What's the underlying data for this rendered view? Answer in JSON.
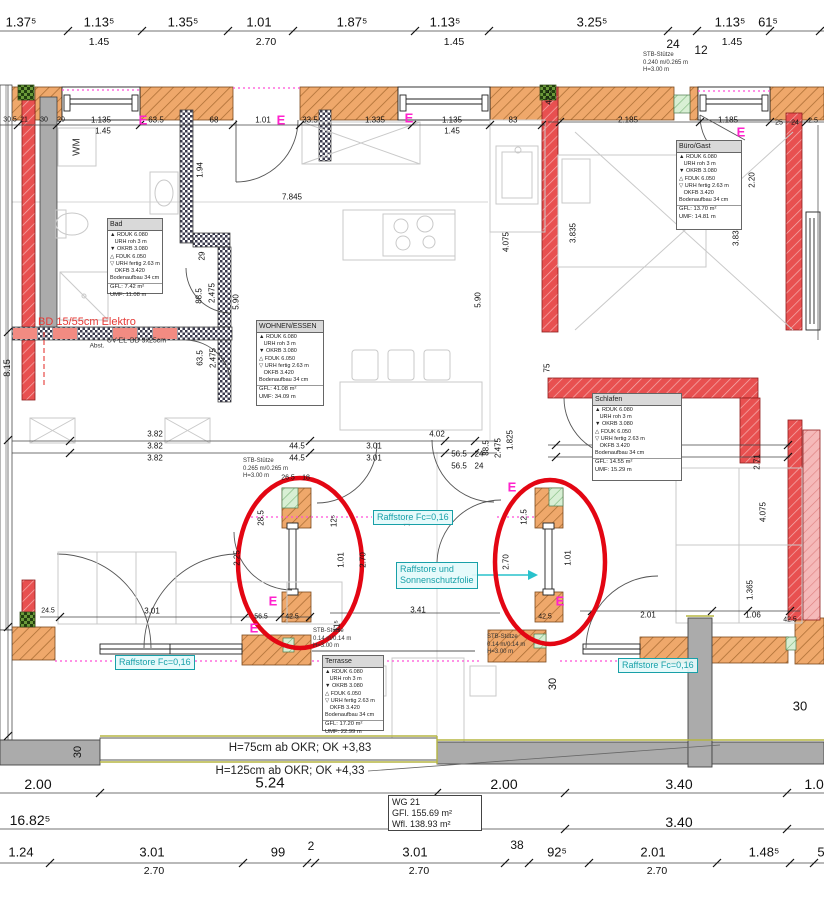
{
  "site": {
    "h75": "H=75cm ab OKR; OK +3,83",
    "h125": "H=125cm ab OKR; OK +4,33"
  },
  "wg_box": {
    "line1": "WG 21",
    "line2": "GFl.   155.69 m²",
    "line3": "Wfl.   138.93 m²"
  },
  "colors": {
    "wall_orange": "#efa86b",
    "wall_red": "#e85050",
    "wall_pink": "#f5b9b9",
    "insulation_green": "#d8efd4",
    "checker_dark": "#3a3a4d",
    "gray_wall": "#ababab",
    "accent_cyan": "#18a0a8",
    "magenta": "#ff22cc",
    "highlight_red": "#e30613",
    "elektro_red": "#e53935",
    "olive": "#b5b542"
  },
  "room_template_lines": "▲ RDUK 6.080\n   URH roh 3 m\n▼ OKRB 3.080\n△ FDUK 6.050\n▽ URH fertig 2.63 m\n   OKFB 3.420\nBodenaufbau 34 cm",
  "rooms": [
    {
      "name": "Bad",
      "x": 107,
      "y": 218,
      "w": 54,
      "h": 74,
      "gfl": "GFL: 7.42 m²",
      "umf": "UMF: 11.08 m"
    },
    {
      "name": "WOHNEN/ESSEN",
      "x": 256,
      "y": 320,
      "w": 66,
      "h": 84,
      "gfl": "GFL: 41.08 m²",
      "umf": "UMF: 34.09 m"
    },
    {
      "name": "Büro/Gast",
      "x": 676,
      "y": 140,
      "w": 64,
      "h": 88,
      "gfl": "GFL: 13.70 m²",
      "umf": "UMF: 14.81 m"
    },
    {
      "name": "Schlafen",
      "x": 592,
      "y": 393,
      "w": 88,
      "h": 86,
      "gfl": "GFL: 14.55 m²",
      "umf": "UMF: 15.29 m"
    },
    {
      "name": "Terrasse",
      "x": 322,
      "y": 655,
      "w": 60,
      "h": 74,
      "gfl": "GFL: 17.20 m²",
      "umf": "UMF: 22.99 m"
    }
  ],
  "stb_labels": [
    {
      "x": 643,
      "y": 52,
      "text": "STB-Stütze\n0.240 m/0.265 m\nH=3.00 m"
    },
    {
      "x": 243,
      "y": 458,
      "text": "STB-Stütze\n0.265 m/0.265 m\nH=3.00 m"
    },
    {
      "x": 313,
      "y": 628,
      "text": "STB-Stütze\n0.14 m/0.14 m\nH=3.00 m"
    },
    {
      "x": 487,
      "y": 634,
      "text": "STB-Stütze\n0.14 m/0.14 m\nH=3.00 m"
    }
  ],
  "raffstore_labels": [
    {
      "x": 115,
      "y": 655,
      "lines": [
        "Raffstore Fc=0,16"
      ]
    },
    {
      "x": 373,
      "y": 510,
      "lines": [
        "Raffstore Fc=0,16"
      ]
    },
    {
      "x": 618,
      "y": 658,
      "lines": [
        "Raffstore Fc=0,16"
      ]
    },
    {
      "x": 396,
      "y": 562,
      "lines": [
        "Raffstore und",
        "Sonnenschutzfolie"
      ]
    }
  ],
  "e_marks": [
    {
      "x": 143,
      "y": 120
    },
    {
      "x": 281,
      "y": 120
    },
    {
      "x": 409,
      "y": 118
    },
    {
      "x": 741,
      "y": 132
    },
    {
      "x": 512,
      "y": 487
    },
    {
      "x": 273,
      "y": 601
    },
    {
      "x": 254,
      "y": 628
    },
    {
      "x": 560,
      "y": 601
    }
  ],
  "texts": [
    {
      "t": "WM",
      "x": 77,
      "y": 147,
      "s": 10,
      "c": "#333",
      "r": 1
    },
    {
      "t": "UV-EL",
      "x": 117,
      "y": 341,
      "s": 7,
      "c": "#333"
    },
    {
      "t": "BD 9x25cm",
      "x": 148,
      "y": 341,
      "s": 7,
      "c": "#333"
    },
    {
      "t": "Abst.",
      "x": 97,
      "y": 346,
      "s": 6.5,
      "c": "#333"
    },
    {
      "t": "BD 15/55cm Elektro",
      "x": 38,
      "y": 322,
      "s": 11,
      "c": "#e53935",
      "left": 1
    }
  ],
  "dims": [
    {
      "t": "1.37⁵",
      "x": 21,
      "y": 22,
      "s": 13
    },
    {
      "t": "1.13⁵",
      "x": 99,
      "y": 22,
      "s": 13
    },
    {
      "t": "1.35⁵",
      "x": 183,
      "y": 22,
      "s": 13
    },
    {
      "t": "1.01",
      "x": 259,
      "y": 22,
      "s": 13
    },
    {
      "t": "1.87⁵",
      "x": 352,
      "y": 22,
      "s": 13
    },
    {
      "t": "1.13⁵",
      "x": 445,
      "y": 22,
      "s": 13
    },
    {
      "t": "3.25⁵",
      "x": 592,
      "y": 22,
      "s": 13
    },
    {
      "t": "1.13⁵",
      "x": 730,
      "y": 22,
      "s": 13
    },
    {
      "t": "61⁵",
      "x": 768,
      "y": 22,
      "s": 13
    },
    {
      "t": "1.45",
      "x": 99,
      "y": 42,
      "s": 10.5
    },
    {
      "t": "2.70",
      "x": 266,
      "y": 42,
      "s": 10.5
    },
    {
      "t": "1.45",
      "x": 454,
      "y": 42,
      "s": 10.5
    },
    {
      "t": "1.45",
      "x": 732,
      "y": 42,
      "s": 10.5
    },
    {
      "t": "24",
      "x": 673,
      "y": 44,
      "s": 12
    },
    {
      "t": "12",
      "x": 701,
      "y": 50,
      "s": 12
    },
    {
      "t": "30.5",
      "x": 10,
      "y": 120,
      "s": 7
    },
    {
      "t": "21",
      "x": 24,
      "y": 120,
      "s": 7
    },
    {
      "t": "30",
      "x": 44,
      "y": 120,
      "s": 7
    },
    {
      "t": "20",
      "x": 61,
      "y": 120,
      "s": 7
    },
    {
      "t": "1.135",
      "x": 101,
      "y": 120,
      "s": 8
    },
    {
      "t": "1.45",
      "x": 103,
      "y": 131,
      "s": 8
    },
    {
      "t": "63.5",
      "x": 156,
      "y": 120,
      "s": 8
    },
    {
      "t": "68",
      "x": 214,
      "y": 120,
      "s": 8
    },
    {
      "t": "1.01",
      "x": 263,
      "y": 120,
      "s": 8
    },
    {
      "t": "33.5",
      "x": 310,
      "y": 120,
      "s": 8
    },
    {
      "t": "1.335",
      "x": 375,
      "y": 120,
      "s": 8
    },
    {
      "t": "1.135",
      "x": 452,
      "y": 120,
      "s": 8
    },
    {
      "t": "1.45",
      "x": 452,
      "y": 131,
      "s": 8
    },
    {
      "t": "83",
      "x": 513,
      "y": 120,
      "s": 8
    },
    {
      "t": "2.185",
      "x": 628,
      "y": 120,
      "s": 8
    },
    {
      "t": "1.185",
      "x": 728,
      "y": 120,
      "s": 8
    },
    {
      "t": "25",
      "x": 779,
      "y": 123,
      "s": 7
    },
    {
      "t": "24",
      "x": 795,
      "y": 123,
      "s": 7
    },
    {
      "t": "2.5",
      "x": 813,
      "y": 121,
      "s": 7
    },
    {
      "t": "42.5",
      "x": 549,
      "y": 97,
      "s": 8,
      "r": 1
    },
    {
      "t": "1.94",
      "x": 200,
      "y": 170,
      "s": 8,
      "r": 1
    },
    {
      "t": "29",
      "x": 202,
      "y": 256,
      "s": 8,
      "r": 1
    },
    {
      "t": "88.5",
      "x": 199,
      "y": 296,
      "s": 8,
      "r": 1
    },
    {
      "t": "2.475",
      "x": 212,
      "y": 293,
      "s": 8,
      "r": 1
    },
    {
      "t": "5.90",
      "x": 236,
      "y": 302,
      "s": 8,
      "r": 1
    },
    {
      "t": "63.5",
      "x": 200,
      "y": 358,
      "s": 8,
      "r": 1
    },
    {
      "t": "2.475",
      "x": 213,
      "y": 358,
      "s": 8,
      "r": 1
    },
    {
      "t": "8.15",
      "x": 7,
      "y": 368,
      "s": 9,
      "r": 1
    },
    {
      "t": "7.845",
      "x": 292,
      "y": 197,
      "s": 8
    },
    {
      "t": "5.90",
      "x": 478,
      "y": 300,
      "s": 8,
      "r": 1
    },
    {
      "t": "4.075",
      "x": 506,
      "y": 242,
      "s": 8,
      "r": 1
    },
    {
      "t": "2.20",
      "x": 752,
      "y": 180,
      "s": 8,
      "r": 1
    },
    {
      "t": "3.835",
      "x": 573,
      "y": 233,
      "s": 8,
      "r": 1
    },
    {
      "t": "3.835",
      "x": 736,
      "y": 236,
      "s": 8,
      "r": 1
    },
    {
      "t": "75",
      "x": 547,
      "y": 368,
      "s": 8,
      "r": 1
    },
    {
      "t": "3.82",
      "x": 155,
      "y": 434,
      "s": 8
    },
    {
      "t": "3.82",
      "x": 155,
      "y": 446,
      "s": 8
    },
    {
      "t": "3.82",
      "x": 155,
      "y": 458,
      "s": 8
    },
    {
      "t": "44.5",
      "x": 297,
      "y": 446,
      "s": 8
    },
    {
      "t": "44.5",
      "x": 297,
      "y": 458,
      "s": 8
    },
    {
      "t": "3.01",
      "x": 374,
      "y": 446,
      "s": 8
    },
    {
      "t": "3.01",
      "x": 374,
      "y": 458,
      "s": 8
    },
    {
      "t": "4.02",
      "x": 437,
      "y": 434,
      "s": 8
    },
    {
      "t": "1.825",
      "x": 510,
      "y": 440,
      "s": 8,
      "r": 1
    },
    {
      "t": "56.5",
      "x": 459,
      "y": 454,
      "s": 8
    },
    {
      "t": "24",
      "x": 479,
      "y": 454,
      "s": 8
    },
    {
      "t": "56.5",
      "x": 459,
      "y": 466,
      "s": 8
    },
    {
      "t": "24",
      "x": 479,
      "y": 466,
      "s": 8
    },
    {
      "t": "88.5",
      "x": 486,
      "y": 448,
      "s": 8,
      "r": 1
    },
    {
      "t": "2.475",
      "x": 498,
      "y": 448,
      "s": 8,
      "r": 1
    },
    {
      "t": "3.57",
      "x": 673,
      "y": 448,
      "s": 8
    },
    {
      "t": "3.57",
      "x": 673,
      "y": 460,
      "s": 8
    },
    {
      "t": "2.71",
      "x": 757,
      "y": 462,
      "s": 8,
      "r": 1
    },
    {
      "t": "4.075",
      "x": 763,
      "y": 512,
      "s": 8,
      "r": 1
    },
    {
      "t": "26.5",
      "x": 288,
      "y": 478,
      "s": 7
    },
    {
      "t": "18",
      "x": 306,
      "y": 478,
      "s": 7
    },
    {
      "t": "28.5",
      "x": 261,
      "y": 518,
      "s": 8,
      "r": 1
    },
    {
      "t": "12⁵",
      "x": 334,
      "y": 521,
      "s": 8,
      "r": 1
    },
    {
      "t": "1.01",
      "x": 341,
      "y": 560,
      "s": 8,
      "r": 1
    },
    {
      "t": "2.70",
      "x": 363,
      "y": 560,
      "s": 8,
      "r": 1
    },
    {
      "t": "2.25",
      "x": 237,
      "y": 558,
      "s": 8,
      "r": 1
    },
    {
      "t": "56.5",
      "x": 261,
      "y": 617,
      "s": 7
    },
    {
      "t": "42.5",
      "x": 292,
      "y": 617,
      "s": 7
    },
    {
      "t": "11⁵",
      "x": 337,
      "y": 626,
      "s": 8,
      "r": 1
    },
    {
      "t": "12⁵",
      "x": 407,
      "y": 520,
      "s": 8,
      "r": 1
    },
    {
      "t": "12.5",
      "x": 524,
      "y": 517,
      "s": 8,
      "r": 1
    },
    {
      "t": "2.70",
      "x": 506,
      "y": 562,
      "s": 8,
      "r": 1
    },
    {
      "t": "1.01",
      "x": 568,
      "y": 558,
      "s": 8,
      "r": 1
    },
    {
      "t": "42.5",
      "x": 545,
      "y": 617,
      "s": 7
    },
    {
      "t": "42.5",
      "x": 790,
      "y": 620,
      "s": 7
    },
    {
      "t": "3.41",
      "x": 418,
      "y": 610,
      "s": 8
    },
    {
      "t": "3.01",
      "x": 152,
      "y": 611,
      "s": 8
    },
    {
      "t": "24.5",
      "x": 48,
      "y": 611,
      "s": 7
    },
    {
      "t": "2.01",
      "x": 648,
      "y": 615,
      "s": 8
    },
    {
      "t": "1.06",
      "x": 753,
      "y": 615,
      "s": 8
    },
    {
      "t": "1.365",
      "x": 750,
      "y": 590,
      "s": 8,
      "r": 1
    },
    {
      "t": "30",
      "x": 78,
      "y": 752,
      "s": 11,
      "r": 1
    },
    {
      "t": "30",
      "x": 553,
      "y": 684,
      "s": 11,
      "r": 1
    },
    {
      "t": "30",
      "x": 800,
      "y": 706,
      "s": 13
    },
    {
      "t": "2.00",
      "x": 38,
      "y": 784,
      "s": 14
    },
    {
      "t": "5.24",
      "x": 270,
      "y": 783,
      "s": 15
    },
    {
      "t": "2.00",
      "x": 504,
      "y": 784,
      "s": 14
    },
    {
      "t": "3.40",
      "x": 679,
      "y": 784,
      "s": 14
    },
    {
      "t": "1.01",
      "x": 818,
      "y": 784,
      "s": 14
    },
    {
      "t": "16.82⁵",
      "x": 30,
      "y": 820,
      "s": 14
    },
    {
      "t": "3.40",
      "x": 679,
      "y": 822,
      "s": 14
    },
    {
      "t": "1.24",
      "x": 21,
      "y": 852,
      "s": 13
    },
    {
      "t": "3.01",
      "x": 152,
      "y": 852,
      "s": 13
    },
    {
      "t": "99",
      "x": 278,
      "y": 852,
      "s": 13
    },
    {
      "t": "2",
      "x": 311,
      "y": 846,
      "s": 12
    },
    {
      "t": "3.01",
      "x": 415,
      "y": 852,
      "s": 13
    },
    {
      "t": "38",
      "x": 517,
      "y": 845,
      "s": 12
    },
    {
      "t": "92⁵",
      "x": 557,
      "y": 852,
      "s": 13
    },
    {
      "t": "2.01",
      "x": 653,
      "y": 852,
      "s": 13
    },
    {
      "t": "1.48⁵",
      "x": 764,
      "y": 852,
      "s": 13
    },
    {
      "t": "5",
      "x": 821,
      "y": 852,
      "s": 13
    },
    {
      "t": "2.70",
      "x": 154,
      "y": 871,
      "s": 10.5
    },
    {
      "t": "2.70",
      "x": 419,
      "y": 871,
      "s": 10.5
    },
    {
      "t": "2.70",
      "x": 657,
      "y": 871,
      "s": 10.5
    }
  ]
}
